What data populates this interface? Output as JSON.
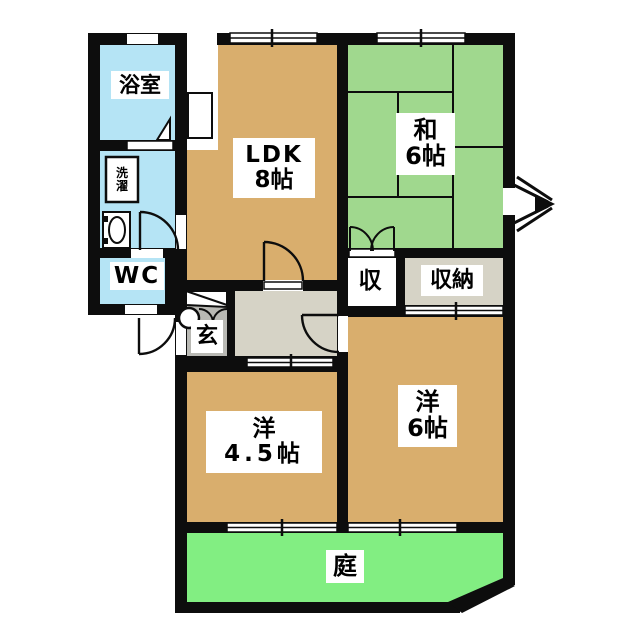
{
  "plan_title": "2LDK apartment floor plan",
  "rooms": {
    "bathroom": {
      "label": "浴室"
    },
    "laundry": {
      "char1": "洗",
      "char2": "濯"
    },
    "wc": {
      "label": "WC"
    },
    "ldk": {
      "label": "LDK",
      "size": "8帖"
    },
    "washitsu": {
      "label": "和",
      "size": "6帖"
    },
    "closet_small": {
      "label": "収"
    },
    "closet_large": {
      "label": "収納"
    },
    "entrance": {
      "label": "玄"
    },
    "western45": {
      "label": "洋",
      "size": "4.5帖"
    },
    "western6": {
      "label": "洋",
      "size": "6帖"
    },
    "garden": {
      "label": "庭"
    }
  },
  "icons": {
    "compass": "north-arrow-icon",
    "bathtub_door": "door-swing-mark",
    "washbasin": "washbasin-oval",
    "kitchen_counter": "kitchen-counter",
    "shoe_cabinet": "shoe-cabinet"
  },
  "colors": {
    "wall_black": "#0d0d0d",
    "room_tan": "#d9ae6d",
    "tatami_green": "#a0d88e",
    "garden_green": "#82ee82",
    "water_blue": "#b5e4f5",
    "hall_greige": "#d6d3c6",
    "entrance_gray": "#b9b9b4",
    "white": "#ffffff"
  }
}
